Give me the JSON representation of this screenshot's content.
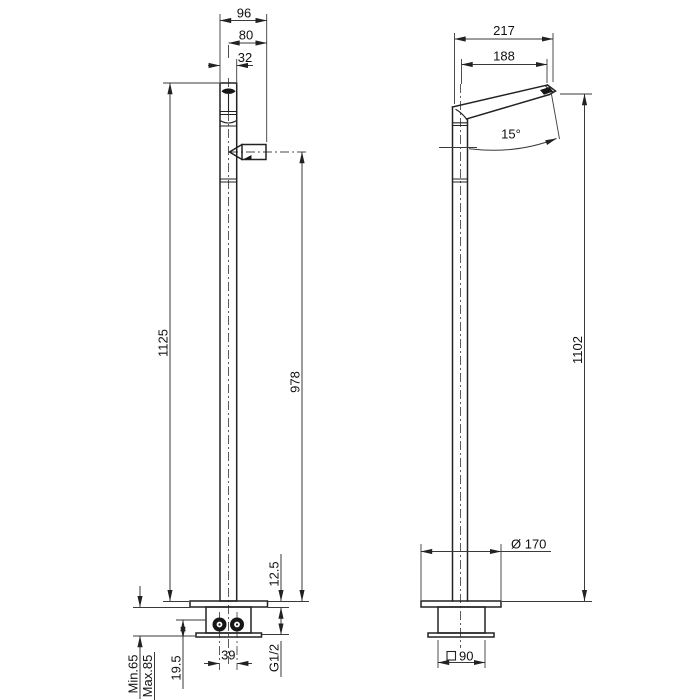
{
  "drawing": {
    "title": "Freestanding single-lever basin mixer — dimensional drawing",
    "views": {
      "front": "front view",
      "side": "side view"
    },
    "dims": {
      "front": {
        "total_width": "96",
        "spout_offset": "80",
        "column_width": "32",
        "total_height": "1125",
        "outlet_height": "978",
        "plate_thickness": "12.5",
        "deck_min": "Min.65",
        "deck_max": "Max.85",
        "inlet_depth": "19.5",
        "inlet_spacing": "39",
        "thread_size": "G1/2"
      },
      "side": {
        "total_reach": "217",
        "outlet_reach": "188",
        "spout_angle": "15°",
        "outlet_height": "1102",
        "base_diameter": "Ø 170",
        "rough_box_size": "90"
      }
    }
  }
}
